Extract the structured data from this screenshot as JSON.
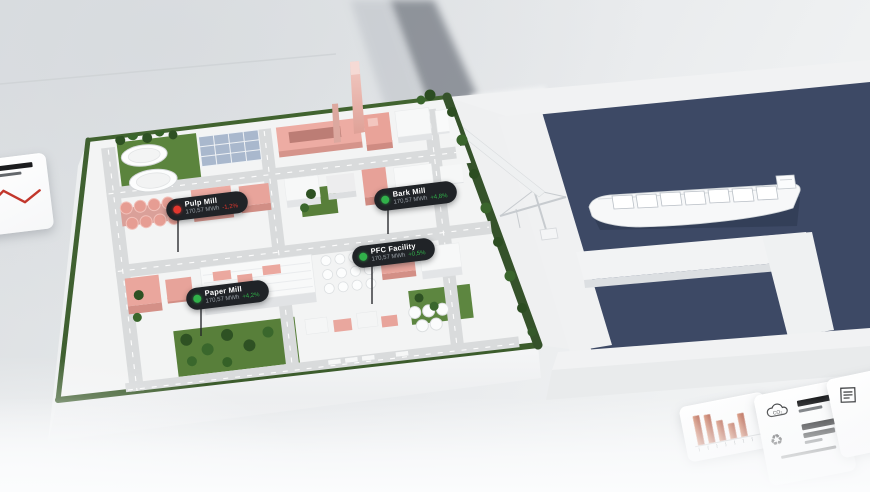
{
  "badges": [
    {
      "id": "pulp-mill",
      "label": "Pulp Mill",
      "value": "170,57 MWh",
      "delta": "-1,2%",
      "trend": "down",
      "dot_color": "#e2372e",
      "delta_color": "#e2372e"
    },
    {
      "id": "bark-mill",
      "label": "Bark Mill",
      "value": "170,57 MWh",
      "delta": "+4,8%",
      "trend": "up",
      "dot_color": "#31b14a",
      "delta_color": "#31b14a"
    },
    {
      "id": "pfc-facility",
      "label": "PFC Facility",
      "value": "170,57 MWh",
      "delta": "+0,5%",
      "trend": "up",
      "dot_color": "#31b14a",
      "delta_color": "#31b14a"
    },
    {
      "id": "paper-mill",
      "label": "Paper Mill",
      "value": "170,57 MWh",
      "delta": "+4,2%",
      "trend": "up",
      "dot_color": "#31b14a",
      "delta_color": "#31b14a"
    }
  ],
  "cards": {
    "trend": {
      "icon": "line-chart-icon",
      "line_color": "#c2372c"
    },
    "production": {
      "type": "bar",
      "values": [
        88,
        84,
        62,
        48,
        70
      ],
      "bar_color": "#bf6a52"
    },
    "sustainability": {
      "co2_label": "CO₂",
      "icons": [
        "co2-cloud-icon",
        "recycle-icon"
      ]
    },
    "certificate": {
      "icon": "certificate-icon"
    }
  },
  "colors": {
    "water": "#3d4965",
    "grass": "#587f3a",
    "hedge": "#3a5a2b",
    "building_pink": "#eba89f",
    "badge_bg": "#202327",
    "status_up": "#31b14a",
    "status_down": "#e2372e"
  }
}
